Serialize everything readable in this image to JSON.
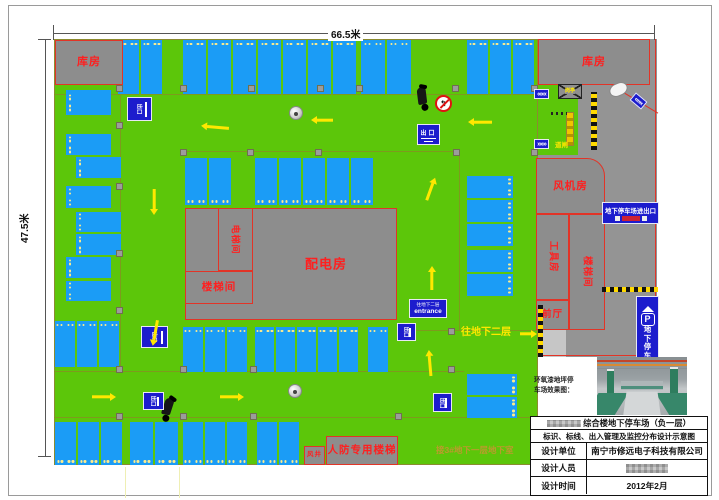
{
  "dims": {
    "top_label": "66.5米",
    "left_label": "47.5米"
  },
  "colors": {
    "green": "#5cc60a",
    "road": "#949494",
    "building": "#8d8d8d",
    "stall": "#1b9cf6",
    "label_red": "#ff1f1f",
    "line_red": "#e23427",
    "yellow": "#ffe800",
    "sign_blue": "#1c1ccd",
    "olive": "#7e9a1e",
    "olive_text": "#bd9a2e"
  },
  "areas": [
    {
      "id": "parking-floor",
      "x": 54,
      "y": 39,
      "w": 484,
      "h": 426,
      "fill": "green",
      "border": "#8b8b30"
    },
    {
      "id": "access-road",
      "x": 538,
      "y": 39,
      "w": 119,
      "h": 318,
      "fill": "road"
    },
    {
      "id": "gate-island",
      "x": 538,
      "y": 85,
      "w": 40,
      "h": 70,
      "fill": "green"
    },
    {
      "id": "ramp-to-b2",
      "x": 540,
      "y": 305,
      "w": 26,
      "h": 52,
      "fill": "#c6c6c6"
    }
  ],
  "lines": [
    {
      "x": 54,
      "y": 94,
      "len": 484,
      "rot": 0,
      "color": "olive"
    },
    {
      "x": 121,
      "y": 95,
      "len": 277,
      "rot": 90,
      "color": "olive"
    },
    {
      "x": 183,
      "y": 151,
      "len": 277,
      "rot": 0,
      "color": "olive"
    },
    {
      "x": 460,
      "y": 152,
      "len": 178,
      "rot": 90,
      "color": "olive"
    },
    {
      "x": 54,
      "y": 371,
      "len": 410,
      "rot": 0,
      "color": "olive"
    },
    {
      "x": 54,
      "y": 417,
      "len": 484,
      "rot": 0,
      "color": "olive"
    },
    {
      "x": 397,
      "y": 330,
      "len": 141,
      "rot": 0,
      "color": "olive"
    },
    {
      "x": 656,
      "y": 39,
      "len": 318,
      "rot": 90,
      "color": "line_red",
      "t": 1.6
    },
    {
      "x": 538,
      "y": 355,
      "len": 119,
      "rot": 0,
      "color": "line_red",
      "t": 1.6
    },
    {
      "x": 612,
      "y": 85,
      "len": 54,
      "rot": 31,
      "color": "line_red",
      "t": 1.6
    }
  ],
  "rooms": [
    {
      "id": "storage-top-left",
      "label": "库房",
      "x": 55,
      "y": 40,
      "w": 68,
      "h": 45,
      "fs": 11
    },
    {
      "id": "storage-top-right",
      "label": "库房",
      "x": 538,
      "y": 39,
      "w": 112,
      "h": 46,
      "fs": 11
    },
    {
      "id": "fan-room",
      "label": "风机房",
      "x": 536,
      "y": 158,
      "w": 69,
      "h": 56,
      "fs": 10.5,
      "rtr": 1
    },
    {
      "id": "tool-room",
      "label": "工具房",
      "x": 536,
      "y": 214,
      "w": 33,
      "h": 86,
      "fs": 9.5,
      "vert": 1
    },
    {
      "id": "stair-room-right",
      "label": "楼梯间",
      "x": 569,
      "y": 214,
      "w": 36,
      "h": 116,
      "fs": 9.5,
      "vert": 1
    },
    {
      "id": "front-hall",
      "label": "前厅",
      "x": 536,
      "y": 300,
      "w": 33,
      "h": 30,
      "fs": 9.5
    },
    {
      "id": "power-distribution-room",
      "label": "配电房",
      "x": 185,
      "y": 208,
      "w": 212,
      "h": 112,
      "fs": 13,
      "lx": 253
    },
    {
      "id": "elevator-room",
      "label": "电梯间",
      "x": 218,
      "y": 208,
      "w": 35,
      "h": 63,
      "fs": 9,
      "vert": 1
    },
    {
      "id": "stair-room-central",
      "label": "楼梯间",
      "x": 185,
      "y": 271,
      "w": 68,
      "h": 33,
      "fs": 10.5
    },
    {
      "id": "civil-defense-stair",
      "label": "人防专用楼梯",
      "x": 326,
      "y": 436,
      "w": 72,
      "h": 29,
      "fs": 10.5
    },
    {
      "id": "air-shaft",
      "label": "风井",
      "x": 304,
      "y": 446,
      "w": 21,
      "h": 19,
      "fs": 6.5
    }
  ],
  "stall_groups": [
    {
      "id": "top-1",
      "x": 118,
      "y": 40,
      "n": 2,
      "dir": "up",
      "sw": 23,
      "sh": 54
    },
    {
      "id": "top-2",
      "x": 183,
      "y": 40,
      "n": 7,
      "dir": "up",
      "sw": 25,
      "sh": 54
    },
    {
      "id": "top-3",
      "x": 361,
      "y": 40,
      "n": 2,
      "dir": "up",
      "sw": 26,
      "sh": 54
    },
    {
      "id": "top-4",
      "x": 467,
      "y": 40,
      "n": 3,
      "dir": "up",
      "sw": 23,
      "sh": 54
    },
    {
      "id": "row2-1",
      "x": 185,
      "y": 158,
      "n": 2,
      "dir": "down",
      "sw": 24,
      "sh": 47
    },
    {
      "id": "row2-2",
      "x": 255,
      "y": 158,
      "n": 5,
      "dir": "down",
      "sw": 24,
      "sh": 47
    },
    {
      "id": "left-1",
      "x": 66,
      "y": 90,
      "n": 1,
      "dir": "left",
      "sw": 45,
      "sh": 27
    },
    {
      "id": "left-2",
      "x": 66,
      "y": 134,
      "n": 1,
      "dir": "left",
      "sw": 45,
      "sh": 23
    },
    {
      "id": "left-3",
      "x": 76,
      "y": 157,
      "n": 1,
      "dir": "left",
      "sw": 45,
      "sh": 23
    },
    {
      "id": "left-4",
      "x": 66,
      "y": 186,
      "n": 1,
      "dir": "left",
      "sw": 45,
      "sh": 24
    },
    {
      "id": "left-5",
      "x": 76,
      "y": 212,
      "n": 1,
      "dir": "left",
      "sw": 45,
      "sh": 22
    },
    {
      "id": "left-6",
      "x": 76,
      "y": 234,
      "n": 1,
      "dir": "left",
      "sw": 45,
      "sh": 23
    },
    {
      "id": "left-7",
      "x": 66,
      "y": 257,
      "n": 1,
      "dir": "left",
      "sw": 45,
      "sh": 23
    },
    {
      "id": "left-8",
      "x": 66,
      "y": 281,
      "n": 1,
      "dir": "left",
      "sw": 45,
      "sh": 22
    },
    {
      "id": "mid-1",
      "x": 55,
      "y": 321,
      "n": 3,
      "dir": "up",
      "sw": 22,
      "sh": 46
    },
    {
      "id": "mid-2",
      "x": 183,
      "y": 327,
      "n": 3,
      "dir": "up",
      "sw": 22,
      "sh": 45
    },
    {
      "id": "mid-3",
      "x": 255,
      "y": 327,
      "n": 5,
      "dir": "up",
      "sw": 21,
      "sh": 45
    },
    {
      "id": "mid-4",
      "x": 368,
      "y": 327,
      "n": 1,
      "dir": "up",
      "sw": 22,
      "sh": 45
    },
    {
      "id": "rcol-1",
      "x": 467,
      "y": 176,
      "n": 3,
      "dir": "right",
      "sw": 46,
      "sh": 24
    },
    {
      "id": "rcol-2",
      "x": 467,
      "y": 250,
      "n": 2,
      "dir": "right",
      "sw": 46,
      "sh": 24
    },
    {
      "id": "rcol-3",
      "x": 467,
      "y": 374,
      "n": 2,
      "dir": "right",
      "sw": 50,
      "sh": 23
    },
    {
      "id": "bot-1",
      "x": 55,
      "y": 422,
      "n": 3,
      "dir": "down",
      "sw": 23,
      "sh": 43
    },
    {
      "id": "bot-2",
      "x": 130,
      "y": 422,
      "n": 2,
      "dir": "down",
      "sw": 25,
      "sh": 43
    },
    {
      "id": "bot-3",
      "x": 183,
      "y": 422,
      "n": 3,
      "dir": "down",
      "sw": 22,
      "sh": 43
    },
    {
      "id": "bot-4",
      "x": 257,
      "y": 422,
      "n": 2,
      "dir": "down",
      "sw": 22,
      "sh": 43
    }
  ],
  "pillars": [
    [
      116,
      85
    ],
    [
      180,
      85
    ],
    [
      248,
      85
    ],
    [
      317,
      85
    ],
    [
      356,
      85
    ],
    [
      452,
      85
    ],
    [
      531,
      85
    ],
    [
      116,
      122
    ],
    [
      116,
      183
    ],
    [
      116,
      250
    ],
    [
      116,
      307
    ],
    [
      180,
      149
    ],
    [
      247,
      149
    ],
    [
      315,
      149
    ],
    [
      453,
      149
    ],
    [
      531,
      149
    ],
    [
      116,
      366
    ],
    [
      180,
      366
    ],
    [
      250,
      366
    ],
    [
      448,
      366
    ],
    [
      448,
      328
    ],
    [
      116,
      413
    ],
    [
      180,
      413
    ],
    [
      250,
      413
    ],
    [
      395,
      413
    ]
  ],
  "arrows": [
    {
      "x": 215,
      "y": 127,
      "rot": 185,
      "len": 28
    },
    {
      "x": 322,
      "y": 120,
      "rot": 180,
      "len": 22
    },
    {
      "x": 480,
      "y": 122,
      "rot": 180,
      "len": 24
    },
    {
      "x": 154,
      "y": 202,
      "rot": 90,
      "len": 26
    },
    {
      "x": 431,
      "y": 189,
      "rot": -70,
      "len": 24
    },
    {
      "x": 155,
      "y": 333,
      "rot": 100,
      "len": 26
    },
    {
      "x": 432,
      "y": 278,
      "rot": -90,
      "len": 24
    },
    {
      "x": 430,
      "y": 363,
      "rot": -95,
      "len": 26
    },
    {
      "x": 104,
      "y": 397,
      "rot": 0,
      "len": 24
    },
    {
      "x": 232,
      "y": 397,
      "rot": 0,
      "len": 24
    },
    {
      "x": 528,
      "y": 334,
      "rot": 0,
      "len": 17
    }
  ],
  "signs": [
    {
      "id": "exit-pictogram-1",
      "type": "mini",
      "x": 127,
      "y": 97,
      "w": 25,
      "h": 24,
      "text": "出口"
    },
    {
      "id": "exit-sign-upper",
      "type": "exit",
      "x": 417,
      "y": 124,
      "w": 23,
      "h": 21,
      "text": "出口"
    },
    {
      "id": "exit-pictogram-2",
      "type": "mini",
      "x": 141,
      "y": 326,
      "w": 27,
      "h": 22,
      "text": "出口"
    },
    {
      "id": "exit-pictogram-3",
      "type": "mini",
      "x": 397,
      "y": 323,
      "w": 19,
      "h": 18,
      "text": "出口"
    },
    {
      "id": "exit-pictogram-4",
      "type": "mini",
      "x": 433,
      "y": 393,
      "w": 19,
      "h": 19,
      "text": "出口"
    },
    {
      "id": "exit-pictogram-5",
      "type": "mini",
      "x": 143,
      "y": 392,
      "w": 21,
      "h": 18,
      "text": "出口"
    },
    {
      "id": "entrance-sign",
      "type": "entrance",
      "x": 409,
      "y": 299,
      "w": 38,
      "h": 19,
      "line1": "往地下二层",
      "line2": "entrance"
    },
    {
      "id": "parking-entrance-sign",
      "type": "banner",
      "x": 602,
      "y": 202,
      "w": 57,
      "h": 22,
      "line1": "地下停车场进出口"
    },
    {
      "id": "p-sign",
      "type": "psign",
      "x": 636,
      "y": 296,
      "w": 23,
      "h": 81,
      "text": "地下停车场",
      "glyph": "P"
    },
    {
      "id": "no-left-turn-sign",
      "type": "noturn",
      "x": 435,
      "y": 95,
      "w": 17,
      "h": 17
    },
    {
      "id": "chevron-left",
      "type": "chevron",
      "x": 534,
      "y": 89,
      "w": 15,
      "h": 10,
      "ch": "«««"
    },
    {
      "id": "chevron-right",
      "type": "chevron",
      "x": 534,
      "y": 139,
      "w": 15,
      "h": 10,
      "ch": "»»»"
    },
    {
      "id": "chevron-corner",
      "type": "chevron",
      "x": 631,
      "y": 96,
      "w": 15,
      "h": 10,
      "ch": "«««",
      "rot": 40
    }
  ],
  "fixtures": [
    {
      "type": "booth",
      "x": 558,
      "y": 84,
      "w": 24,
      "h": 15,
      "label": "岗亭"
    },
    {
      "type": "gatearm",
      "x": 566,
      "y": 112,
      "w": 8,
      "h": 34
    },
    {
      "type": "dotline",
      "x": 551,
      "y": 112,
      "w": 16,
      "h": 3
    },
    {
      "type": "barrier",
      "x": 591,
      "y": 92,
      "w": 6,
      "h": 58,
      "o": "v"
    },
    {
      "type": "barrier",
      "x": 602,
      "y": 287,
      "w": 56,
      "h": 5,
      "o": "h"
    },
    {
      "type": "barrier",
      "x": 538,
      "y": 305,
      "w": 5,
      "h": 52,
      "o": "v"
    },
    {
      "type": "mirror",
      "x": 609,
      "y": 83,
      "w": 19,
      "h": 13
    },
    {
      "type": "moto",
      "x": 413,
      "y": 85,
      "w": 20,
      "h": 26,
      "rot": -15
    },
    {
      "type": "moto",
      "x": 158,
      "y": 396,
      "w": 20,
      "h": 26,
      "rot": 10
    },
    {
      "type": "dome",
      "x": 289,
      "y": 106,
      "w": 14,
      "h": 14
    },
    {
      "type": "dome",
      "x": 288,
      "y": 384,
      "w": 14,
      "h": 14
    }
  ],
  "labels": [
    {
      "id": "to-basement2-label",
      "text": "往地下二层",
      "x": 461,
      "y": 328,
      "fs": 10,
      "color": "yellow"
    },
    {
      "id": "connect-note",
      "text": "接3#地下一层地下室",
      "x": 436,
      "y": 446,
      "fs": 8.5,
      "color": "olive_text"
    },
    {
      "id": "gate-arm-label",
      "text": "道闸",
      "x": 555,
      "y": 143,
      "fs": 6.5,
      "color": "yellow"
    }
  ],
  "titleblock": {
    "caption1": "环氧漆地坪停",
    "caption2": "车场效果图：",
    "title_line1": "综合楼地下停车场（负一层）",
    "title_line2": "标识、标线、出入管理及监控分布设计示意图",
    "rows": [
      {
        "label": "设计单位",
        "value": "南宁市修远电子科技有限公司"
      },
      {
        "label": "设计人员",
        "value": "",
        "redacted": true
      },
      {
        "label": "设计时间",
        "value": "2012年2月"
      }
    ]
  }
}
